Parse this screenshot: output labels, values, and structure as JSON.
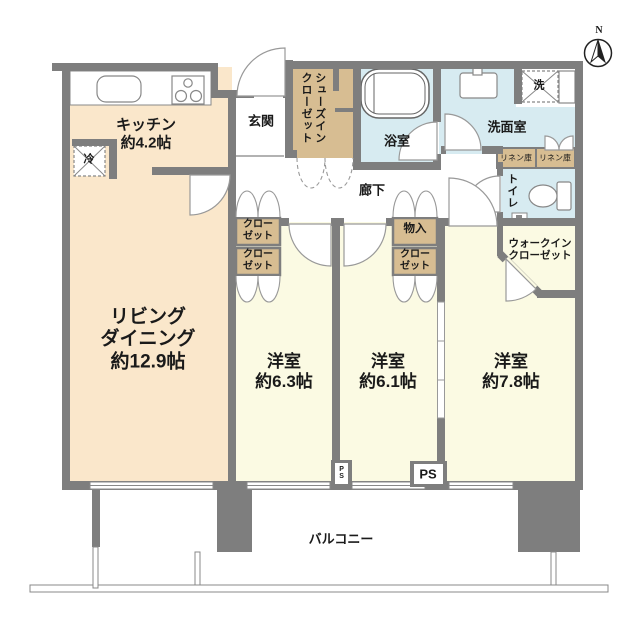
{
  "palette": {
    "wall": "#7E7E7E",
    "ldk_fill": "#FAE7CB",
    "bedroom_fill": "#FBFAE3",
    "wet_area_fill": "#D7EBF1",
    "closet_fill": "#D7BD92",
    "line": "#888888",
    "text": "#1A1A1A"
  },
  "compass": {
    "label": "N"
  },
  "rooms": {
    "kitchen": {
      "label": "キッチン\n約4.2帖"
    },
    "living_dining": {
      "label": "リビング\nダイニング\n約12.9帖"
    },
    "bedroom1": {
      "label": "洋室\n約6.3帖"
    },
    "bedroom2": {
      "label": "洋室\n約6.1帖"
    },
    "bedroom3": {
      "label": "洋室\n約7.8帖"
    },
    "entrance": {
      "label": "玄関"
    },
    "shoes_in_closet": {
      "label": "シューズイン\nクローゼット"
    },
    "bathroom": {
      "label": "浴室"
    },
    "washroom": {
      "label": "洗面室"
    },
    "toilet": {
      "label": "トイレ"
    },
    "corridor": {
      "label": "廊下"
    },
    "balcony": {
      "label": "バルコニー"
    },
    "walk_in_closet": {
      "label": "ウォークイン\nクローゼット"
    }
  },
  "storage": {
    "hall_closet": {
      "label": "クロー\nゼット"
    },
    "bedroom1_closet": {
      "label": "クロー\nゼット"
    },
    "monoire": {
      "label": "物入"
    },
    "bedroom2_closet": {
      "label": "クロー\nゼット"
    },
    "linen_left": {
      "label": "リネン庫"
    },
    "linen_right": {
      "label": "リネン庫"
    }
  },
  "fixtures": {
    "refrigerator": {
      "label": "冷"
    },
    "washing_machine": {
      "label": "洗"
    },
    "pipe_space_small": {
      "label": "PS"
    },
    "pipe_space_large": {
      "label": "PS"
    }
  }
}
